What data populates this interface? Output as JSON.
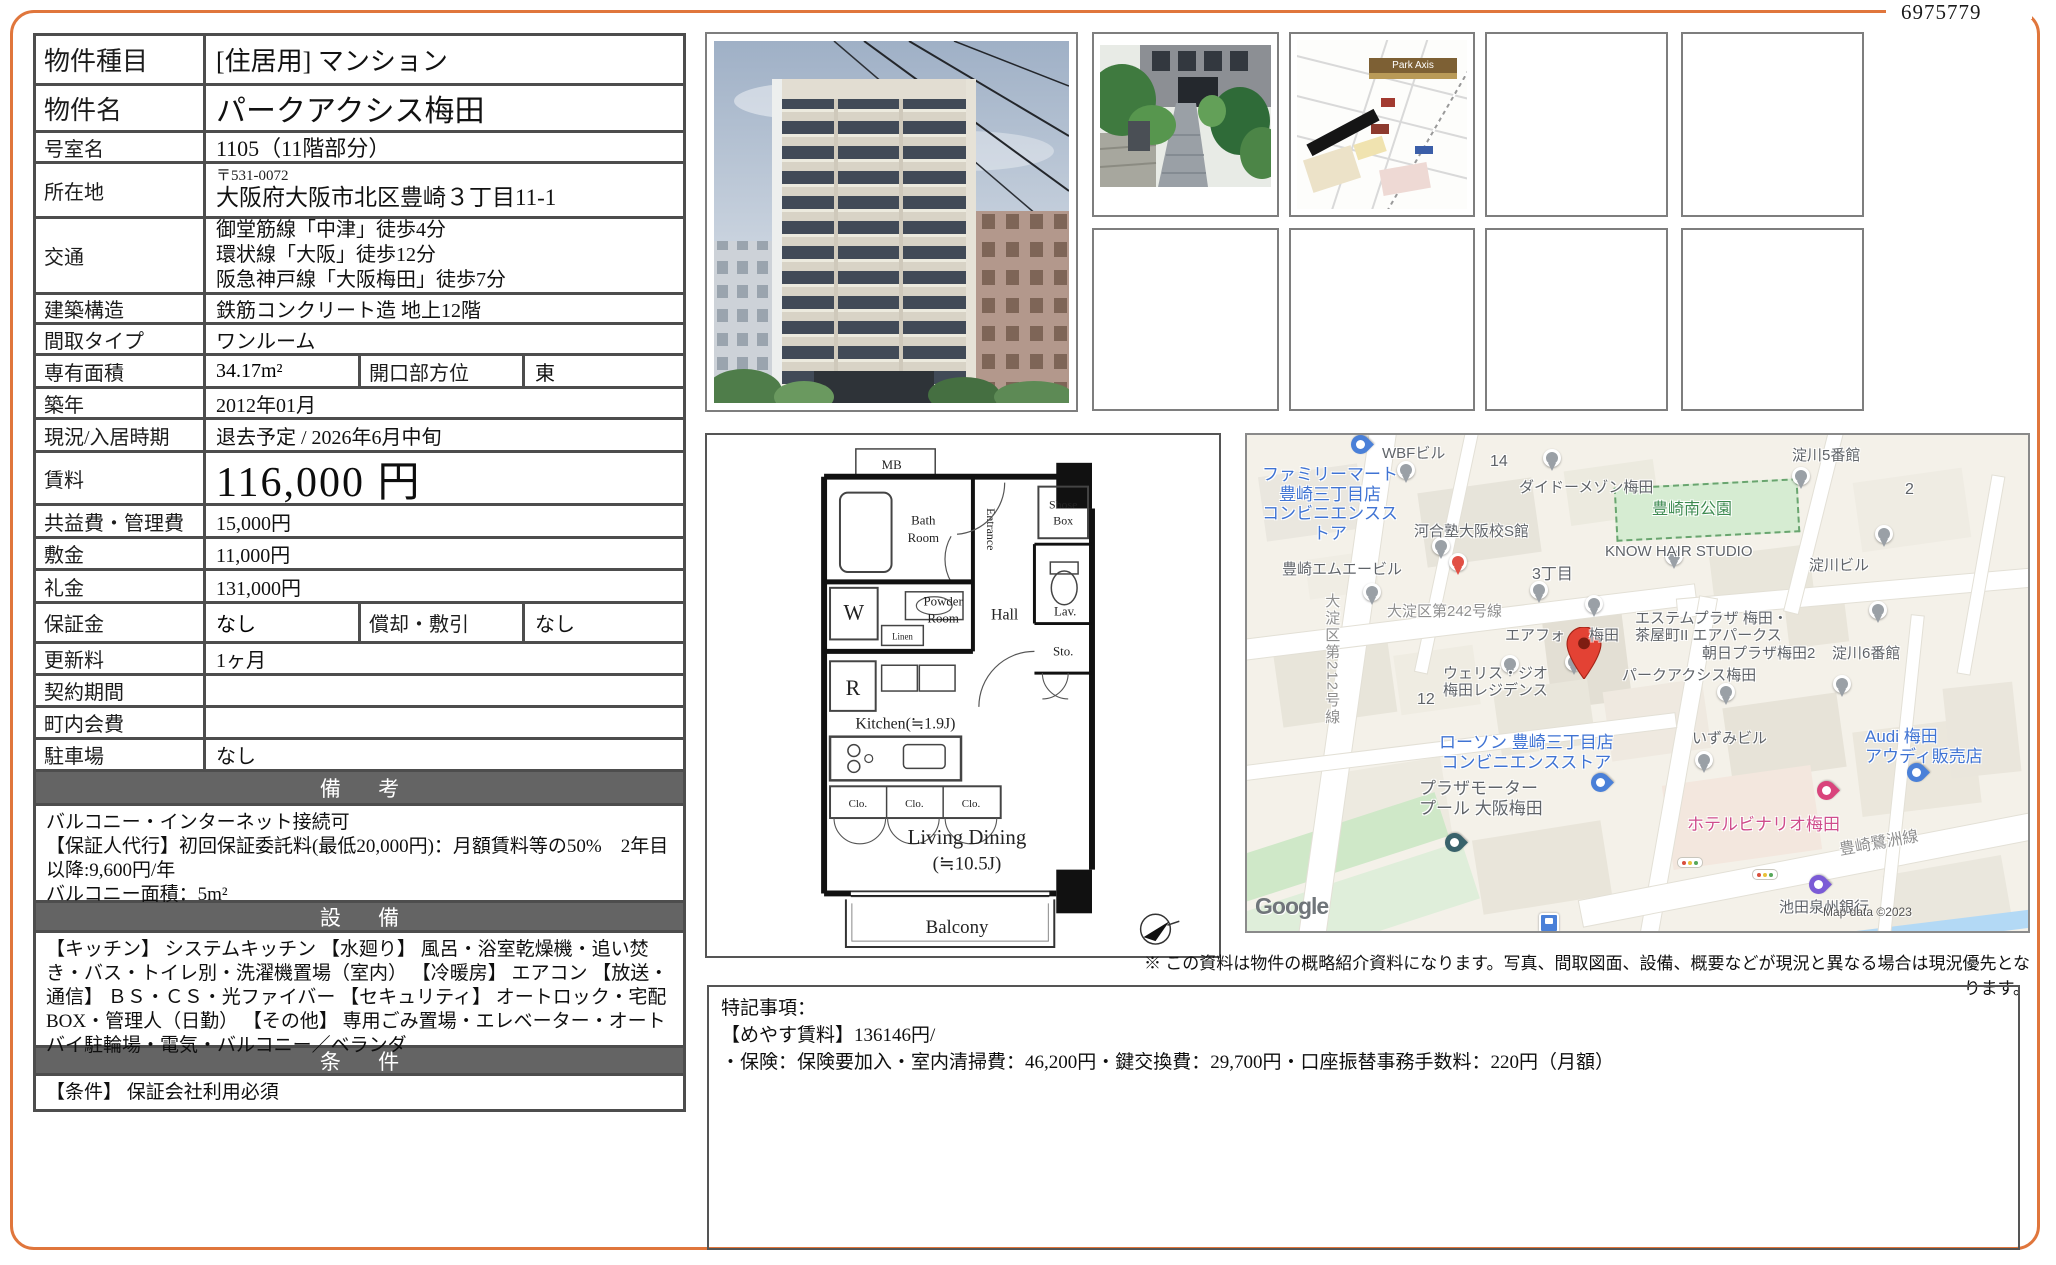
{
  "doc": {
    "ref_number": "6975779",
    "disclaimer": "※ この資料は物件の概略紹介資料になります。写真、間取図面、設備、概要などが現況と異なる場合は現況優先となります。"
  },
  "property": {
    "type": {
      "label": "物件種目",
      "value": "[住居用]  マンション"
    },
    "name": {
      "label": "物件名",
      "value": "パークアクシス梅田"
    },
    "room": {
      "label": "号室名",
      "value": "1105（11階部分）"
    },
    "address": {
      "label": "所在地",
      "postal": "〒531-0072",
      "value": "大阪府大阪市北区豊崎３丁目11-1"
    },
    "access": {
      "label": "交通",
      "lines": [
        "御堂筋線「中津」徒歩4分",
        "環状線「大阪」徒歩12分",
        "阪急神戸線「大阪梅田」徒歩7分"
      ]
    },
    "structure": {
      "label": "建築構造",
      "value": "鉄筋コンクリート造 地上12階"
    },
    "layout": {
      "label": "間取タイプ",
      "value": "ワンルーム"
    },
    "area": {
      "label": "専有面積",
      "value": "34.17m²",
      "facing_label": "開口部方位",
      "facing_value": "東"
    },
    "built": {
      "label": "築年",
      "value": "2012年01月"
    },
    "status": {
      "label": "現況/入居時期",
      "value": "退去予定 / 2026年6月中旬"
    },
    "rent": {
      "label": "賃料",
      "value": "116,000 円"
    },
    "fees": {
      "label": "共益費・管理費",
      "value": "15,000円"
    },
    "deposit": {
      "label": "敷金",
      "value": "11,000円"
    },
    "key_money": {
      "label": "礼金",
      "value": "131,000円"
    },
    "guarantee": {
      "label": "保証金",
      "value": "なし",
      "amort_label": "償却・敷引",
      "amort_value": "なし"
    },
    "renewal": {
      "label": "更新料",
      "value": "1ヶ月"
    },
    "contract": {
      "label": "契約期間",
      "value": ""
    },
    "chonai": {
      "label": "町内会費",
      "value": ""
    },
    "parking": {
      "label": "駐車場",
      "value": "なし"
    }
  },
  "remarks": {
    "header": "備 考",
    "lines": [
      "バルコニー・インターネット接続可",
      "【保証人代行】初回保証委託料(最低20,000円)：月額賃料等の50%　2年目以降:9,600円/年",
      "バルコニー面積：5m²"
    ]
  },
  "equipment": {
    "header": "設 備",
    "text": "【キッチン】 システムキッチン 【水廻り】 風呂・浴室乾燥機・追い焚き・バス・トイレ別・洗濯機置場（室内） 【冷暖房】 エアコン 【放送・通信】 ＢＳ・ＣＳ・光ファイバー 【セキュリティ】 オートロック・宅配BOX・管理人（日勤） 【その他】 専用ごみ置場・エレベーター・オートバイ駐輪場・電気・バルコニー／ベランダ"
  },
  "conditions": {
    "header": "条 件",
    "text": "【条件】 保証会社利用必須"
  },
  "notes": {
    "title": "特記事項：",
    "lines": [
      "【めやす賃料】136146円/",
      "・保険：保険要加入・室内清掃費：46,200円・鍵交換費：29,700円・口座振替事務手数料：220円（月額）"
    ]
  },
  "floorplan": {
    "mb": "MB",
    "bath_1": "Bath",
    "bath_2": "Room",
    "powder_1": "Powder",
    "powder_2": "Room",
    "entrance": "Entrance",
    "shoe_1": "Shose",
    "shoe_2": "Box",
    "hall": "Hall",
    "lav": "Lav.",
    "sto": "Sto.",
    "washer": "W",
    "fridge": "R",
    "linen": "Linen",
    "kitchen": "Kitchen(≒1.9J)",
    "clo": "Clo.",
    "living_1": "Living Dining",
    "living_2": "(≒10.5J)",
    "balcony": "Balcony"
  },
  "photos": {
    "access_badge": "Park Axis"
  },
  "map": {
    "google_logo": "Google",
    "copyright": "Map data ©2023",
    "labels": [
      {
        "text": "ファミリーマート\n豊崎三丁目店\nコンビニエンスストア"
      },
      {
        "text": "WBFビル"
      },
      {
        "text": "14"
      },
      {
        "text": "ダイドーメゾン梅田"
      },
      {
        "text": "豊崎南公園"
      },
      {
        "text": "淀川5番館"
      },
      {
        "text": "2"
      },
      {
        "text": "河合塾大阪校S館"
      },
      {
        "text": "KNOW HAIR STUDIO"
      },
      {
        "text": "淀川ビル"
      },
      {
        "text": "豊崎エムエービル"
      },
      {
        "text": "3丁目"
      },
      {
        "text": "大淀区第242号線"
      },
      {
        "text": "大淀区第212号線"
      },
      {
        "text": "エアフォ"
      },
      {
        "text": "梅田"
      },
      {
        "text": "エステムプラザ 梅田・\n茶屋町II エアパークス"
      },
      {
        "text": "朝日プラザ梅田2"
      },
      {
        "text": "淀川6番館"
      },
      {
        "text": "ウェリス・ジオ\n梅田レジデンス"
      },
      {
        "text": "パークアクシス梅田"
      },
      {
        "text": "12"
      },
      {
        "text": "ローソン 豊崎三丁目店\nコンビニエンスストア"
      },
      {
        "text": "いずみビル"
      },
      {
        "text": "Audi 梅田\nアウディ販売店"
      },
      {
        "text": "プラザモーター\nプール 大阪梅田"
      },
      {
        "text": "ホテルビナリオ梅田"
      },
      {
        "text": "豊崎鷺洲線"
      },
      {
        "text": "池田泉州銀行"
      }
    ]
  }
}
